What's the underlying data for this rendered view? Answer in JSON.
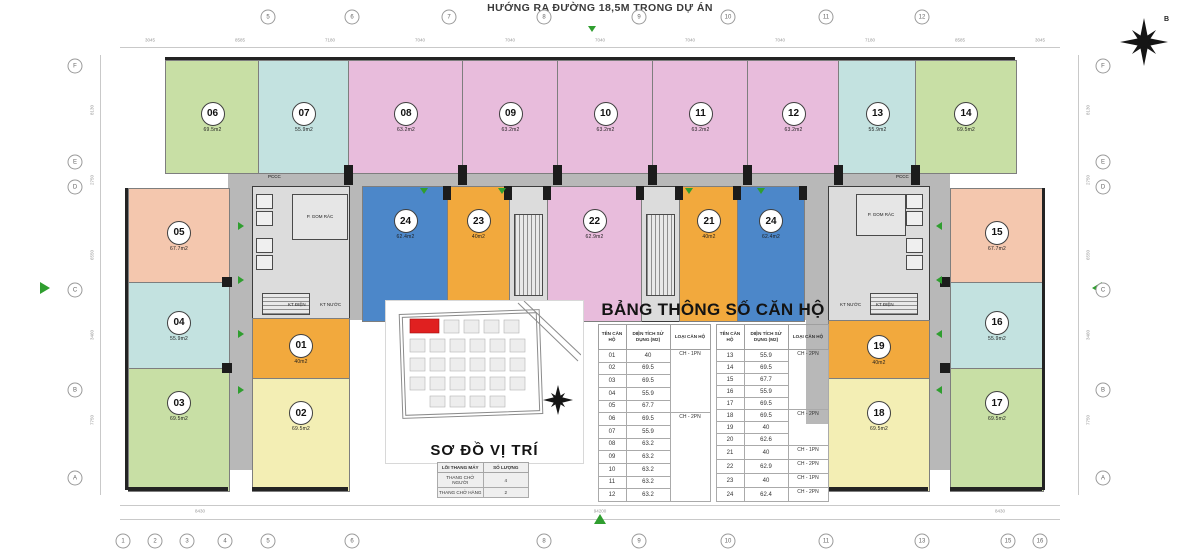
{
  "page": {
    "title_top": "HƯỚNG RA ĐƯỜNG 18,5M TRONG DỰ ÁN"
  },
  "colors": {
    "green": "#c8dfa5",
    "cyan": "#c3e2e0",
    "pink": "#e8bcdc",
    "blue": "#4c87c9",
    "orange": "#f2a93d",
    "yellow": "#f3eeb4",
    "salmon": "#f4c7ae",
    "corridor": "#b8b8b8",
    "wall": "#232323",
    "arrow_green": "#2f9e2f",
    "map_highlight": "#e02020"
  },
  "units": {
    "u01": {
      "num": "01",
      "area": "40m2",
      "color": "#f2a93d"
    },
    "u02": {
      "num": "02",
      "area": "69.5m2",
      "color": "#f3eeb4"
    },
    "u03": {
      "num": "03",
      "area": "69.5m2",
      "color": "#c8dfa5"
    },
    "u04": {
      "num": "04",
      "area": "55.9m2",
      "color": "#c3e2e0"
    },
    "u05": {
      "num": "05",
      "area": "67.7m2",
      "color": "#f4c7ae"
    },
    "u06": {
      "num": "06",
      "area": "69.5m2",
      "color": "#c8dfa5"
    },
    "u07": {
      "num": "07",
      "area": "55.9m2",
      "color": "#c3e2e0"
    },
    "u08": {
      "num": "08",
      "area": "63.2m2",
      "color": "#e8bcdc"
    },
    "u09": {
      "num": "09",
      "area": "63.2m2",
      "color": "#e8bcdc"
    },
    "u10": {
      "num": "10",
      "area": "63.2m2",
      "color": "#e8bcdc"
    },
    "u11": {
      "num": "11",
      "area": "63.2m2",
      "color": "#e8bcdc"
    },
    "u12": {
      "num": "12",
      "area": "63.2m2",
      "color": "#e8bcdc"
    },
    "u13": {
      "num": "13",
      "area": "55.9m2",
      "color": "#c3e2e0"
    },
    "u14": {
      "num": "14",
      "area": "69.5m2",
      "color": "#c8dfa5"
    },
    "u15": {
      "num": "15",
      "area": "67.7m2",
      "color": "#f4c7ae"
    },
    "u16": {
      "num": "16",
      "area": "55.9m2",
      "color": "#c3e2e0"
    },
    "u17": {
      "num": "17",
      "area": "69.5m2",
      "color": "#c8dfa5"
    },
    "u18": {
      "num": "18",
      "area": "69.5m2",
      "color": "#f3eeb4"
    },
    "u19": {
      "num": "19",
      "area": "40m2",
      "color": "#f2a93d"
    },
    "u21": {
      "num": "21",
      "area": "40m2",
      "color": "#f2a93d"
    },
    "u22": {
      "num": "22",
      "area": "62.9m2",
      "color": "#e8bcdc"
    },
    "u23": {
      "num": "23",
      "area": "40m2",
      "color": "#f2a93d"
    },
    "u24a": {
      "num": "24",
      "area": "62.4m2",
      "color": "#4c87c9"
    },
    "u24b": {
      "num": "24",
      "area": "62.4m2",
      "color": "#4c87c9"
    }
  },
  "core_labels": {
    "gom_rac": "P. GOM RÁC",
    "kt_dien": "KT ĐIỆN",
    "kt_nuoc": "KT NƯỚC",
    "pccc": "PCCC"
  },
  "spec_table": {
    "title": "BẢNG THÔNG SỐ CĂN HỘ",
    "headers": [
      "TÊN CĂN HỘ",
      "DIỆN TÍCH SỬ DỤNG (M2)",
      "LOẠI CĂN HỘ"
    ],
    "left_rows": [
      [
        "01",
        "40",
        "CH - 1PN"
      ],
      [
        "02",
        "69.5",
        ""
      ],
      [
        "03",
        "69.5",
        ""
      ],
      [
        "04",
        "55.9",
        ""
      ],
      [
        "05",
        "67.7",
        ""
      ],
      [
        "06",
        "69.5",
        "CH - 2PN"
      ],
      [
        "07",
        "55.9",
        ""
      ],
      [
        "08",
        "63.2",
        ""
      ],
      [
        "09",
        "63.2",
        ""
      ],
      [
        "10",
        "63.2",
        ""
      ],
      [
        "11",
        "63.2",
        ""
      ],
      [
        "12",
        "63.2",
        ""
      ]
    ],
    "right_rows": [
      [
        "13",
        "55.9",
        "CH - 2PN"
      ],
      [
        "14",
        "69.5",
        ""
      ],
      [
        "15",
        "67.7",
        ""
      ],
      [
        "16",
        "55.9",
        ""
      ],
      [
        "17",
        "69.5",
        ""
      ],
      [
        "18",
        "69.5",
        "CH - 2PN"
      ],
      [
        "19",
        "40",
        ""
      ],
      [
        "20",
        "62.6",
        ""
      ],
      [
        "21",
        "40",
        "CH - 1PN"
      ],
      [
        "22",
        "62.9",
        "CH - 2PN"
      ],
      [
        "23",
        "40",
        "CH - 1PN"
      ],
      [
        "24",
        "62.4",
        "CH - 2PN"
      ]
    ]
  },
  "elevator_table": {
    "headers": [
      "LÕI THANG MÁY",
      "SỐ LƯỢNG"
    ],
    "rows": [
      [
        "THANG CHỞ NGƯỜI",
        "4"
      ],
      [
        "THANG CHỞ HÀNG",
        "2"
      ]
    ]
  },
  "map": {
    "caption": "SƠ ĐỒ VỊ TRÍ"
  },
  "compass": {
    "label": "B"
  },
  "grid": {
    "top": [
      "5",
      "6",
      "7",
      "8",
      "9",
      "10",
      "11",
      "12"
    ],
    "bottom": [
      "1",
      "2",
      "3",
      "4",
      "5",
      "6",
      "8",
      "9",
      "10",
      "11",
      "13",
      "15",
      "16"
    ],
    "left": [
      "F",
      "E",
      "D",
      "C",
      "B",
      "A"
    ],
    "right": [
      "F",
      "E",
      "D",
      "C",
      "B",
      "A"
    ],
    "top_dims": [
      "3045",
      "8585",
      "7180",
      "7040",
      "7040",
      "7040",
      "7040",
      "7040",
      "7180",
      "8585",
      "3045"
    ],
    "bottom_dims": [
      "8430",
      "94200",
      "8430"
    ],
    "side_dims": [
      "8130",
      "2750",
      "6550",
      "3460",
      "7750"
    ]
  }
}
